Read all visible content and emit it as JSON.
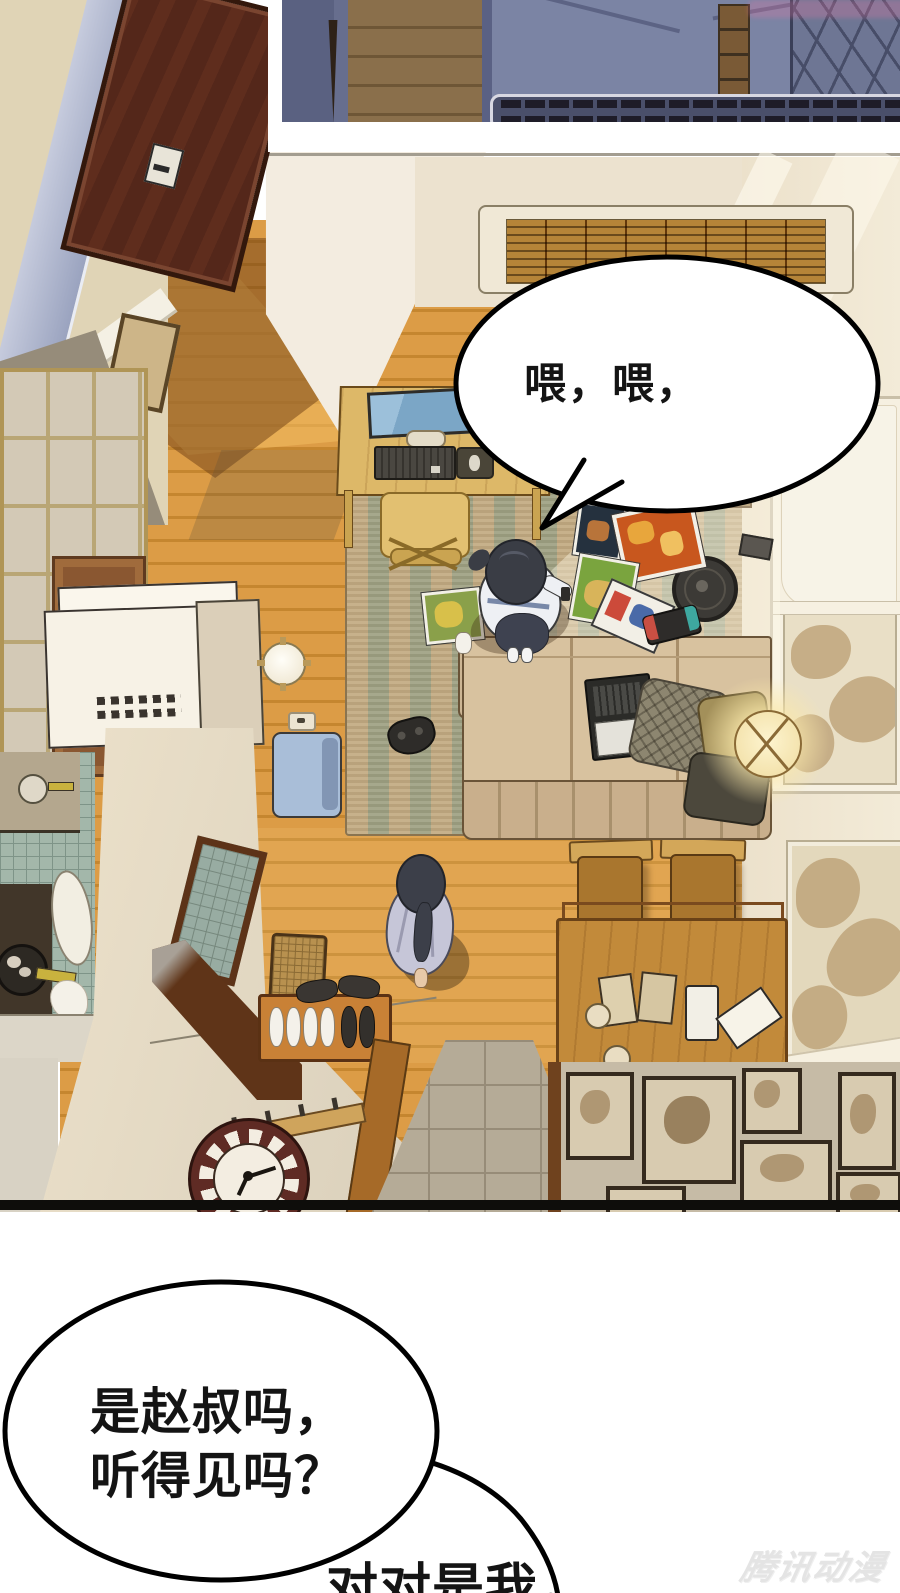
{
  "speech": {
    "bubble_top": "喂，喂，",
    "bubble_left_line1": "是赵叔吗，",
    "bubble_left_line2": "听得见吗？",
    "bubble_bottom": "对对是我，"
  },
  "watermark": "腾讯动漫",
  "colors": {
    "floor_wood": "#d9983f",
    "rug_tan": "#c3ab82",
    "rug_green": "#9fa183",
    "wall_cream": "#ece2cf",
    "night_panel": "#676e8e",
    "door_brown": "#5f2d1d",
    "sofa_beige": "#d8c29f",
    "kitchen_tile": "#a3b7aa",
    "bubble_outline": "#000000",
    "watermark_grey": "#e4e4e4"
  }
}
